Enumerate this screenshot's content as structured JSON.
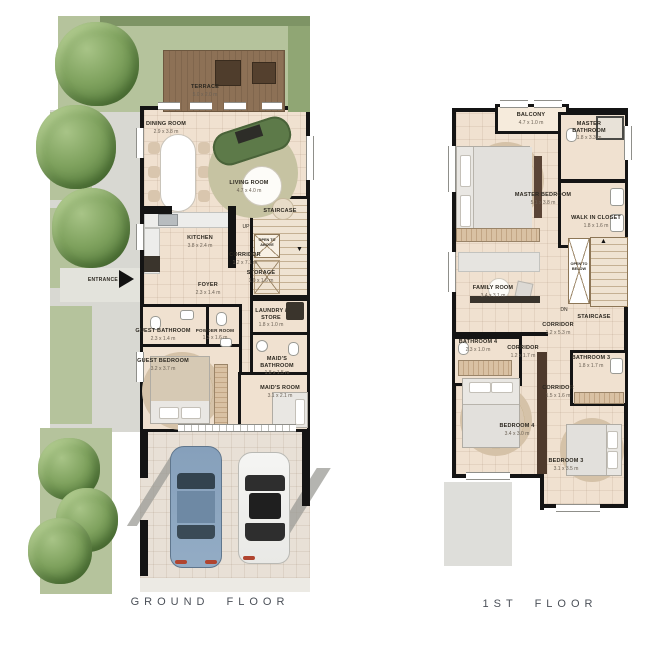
{
  "ground": {
    "title": "GROUND FLOOR",
    "entrance": {
      "label": "ENTRANCE"
    },
    "rooms": {
      "terrace": {
        "label": "TERRACE",
        "dims": "5.0 x 2.0 m"
      },
      "dining": {
        "label": "DINING ROOM",
        "dims": "2.9 x 3.8 m"
      },
      "living": {
        "label": "LIVING ROOM",
        "dims": "4.7 x 4.0 m"
      },
      "kitchen": {
        "label": "KITCHEN",
        "dims": "3.8 x 2.4 m"
      },
      "staircase": {
        "label": "STAIRCASE",
        "up": "UP",
        "open": "OPEN TO ABOVE"
      },
      "corridor": {
        "label": "CORRIDOR",
        "dims": "1.2 x 7.1 m"
      },
      "storage": {
        "label": "STORAGE",
        "dims": "1.0 x 1.6 m"
      },
      "foyer": {
        "label": "FOYER",
        "dims": "2.3 x 1.4 m"
      },
      "guest_bathroom": {
        "label": "GUEST BATHROOM",
        "dims": "2.3 x 1.4 m"
      },
      "powder_room": {
        "label": "POWDER ROOM",
        "dims": "1.3 x 1.6 m"
      },
      "guest_bedroom": {
        "label": "GUEST BEDROOM",
        "dims": "3.2 x 3.7 m"
      },
      "laundry": {
        "label": "LAUNDRY / STORE",
        "dims": "1.8 x 1.0 m"
      },
      "maids_bathroom": {
        "label": "MAID'S BATHROOM",
        "dims": "1.8 x 1.5 m"
      },
      "maids_room": {
        "label": "MAID'S ROOM",
        "dims": "3.1 x 2.1 m"
      }
    }
  },
  "first": {
    "title": "1ST FLOOR",
    "rooms": {
      "balcony": {
        "label": "BALCONY",
        "dims": "4.7 x 1.0 m"
      },
      "master_bathroom": {
        "label": "MASTER BATHROOM",
        "dims": "1.8 x 3.3 m"
      },
      "master_bedroom": {
        "label": "MASTER BEDROOM",
        "dims": "5.1 x 3.8 m"
      },
      "walk_in_closet": {
        "label": "WALK IN CLOSET",
        "dims": "1.8 x 1.6 m"
      },
      "family_room": {
        "label": "FAMILY ROOM",
        "dims": "3.4 x 3.1 m"
      },
      "open_below": {
        "label": "OPEN TO BELOW"
      },
      "staircase": {
        "label": "STAIRCASE",
        "dn": "DN"
      },
      "corridor_main": {
        "label": "CORRIDOR",
        "dims": "1.2 x 5.3 m"
      },
      "bathroom4": {
        "label": "BATHROOM 4",
        "dims": "2.3 x 1.0 m"
      },
      "corridor_2": {
        "label": "CORRIDOR",
        "dims": "1.2 x 1.7 m"
      },
      "bathroom3": {
        "label": "BATHROOM 3",
        "dims": "1.8 x 1.7 m"
      },
      "corridor_3": {
        "label": "CORRIDOR",
        "dims": "1.5 x 1.6 m"
      },
      "bedroom4": {
        "label": "BEDROOM 4",
        "dims": "3.4 x 3.0 m"
      },
      "bedroom3": {
        "label": "BEDROOM 3",
        "dims": "3.1 x 3.5 m"
      }
    }
  },
  "colors": {
    "wall": "#141414",
    "floor": "#f0e1d0",
    "grass": "#b5c39c",
    "wood": "#8f7357",
    "accent_sofa": "#5d7a49"
  }
}
